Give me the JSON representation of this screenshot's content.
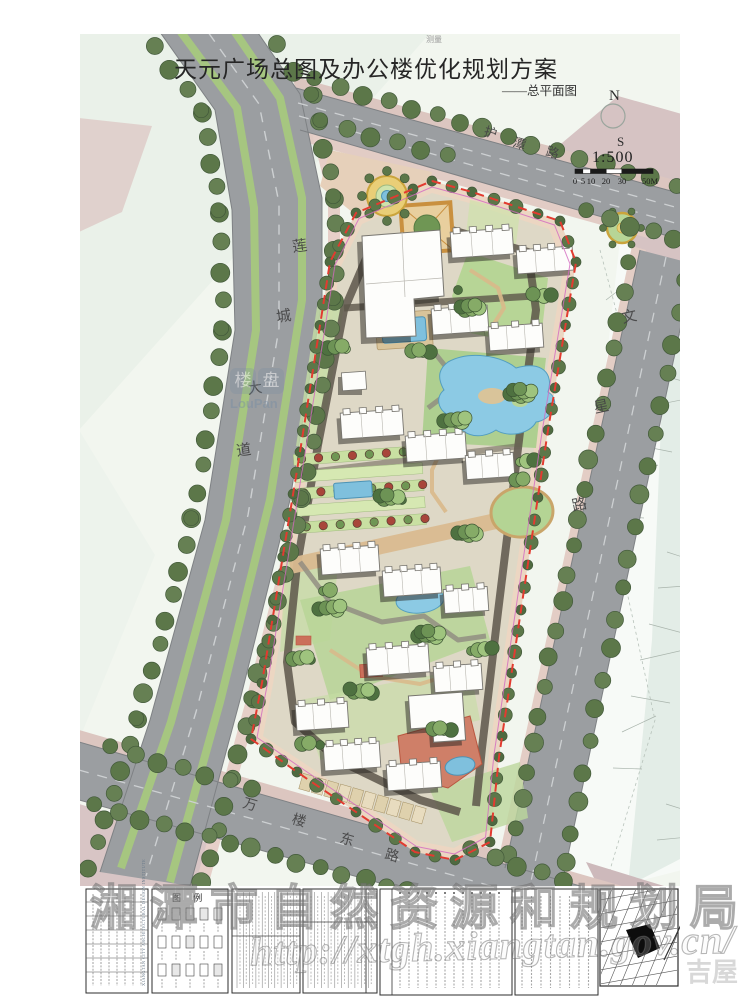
{
  "sheet": {
    "title": "天元广场总图及办公楼优化规划方案",
    "subtitle": "——总平面图",
    "survey_note": "测量",
    "compass_n": "N",
    "compass_s": "S",
    "scale_ratio": "1:500",
    "scale_labels": [
      "0",
      "5",
      "10",
      "20",
      "30",
      "50M"
    ]
  },
  "roads": {
    "west": "莲城大道",
    "north": "护潭路",
    "east": "文星路",
    "south": "万楼东路"
  },
  "titleblock": {
    "legend_title": "图 例",
    "institute": "XIANGTAN CITY ARCHITECTURAL DESIGN INSTITUTE"
  },
  "watermarks": {
    "bureau": "湘潭市自然资源和规划局",
    "url": "http://xtgh.xiangtan.gov.cn/",
    "corner": "吉屋",
    "logo_cn": "楼盘",
    "logo_en": "LouPan"
  },
  "colors": {
    "boundary_red": "#e23b30",
    "water_blue": "#7fc0dd",
    "road_gray": "#9b9ea1",
    "tree_green": "#5c7749",
    "parcel_pink": "#d6c3c3"
  }
}
